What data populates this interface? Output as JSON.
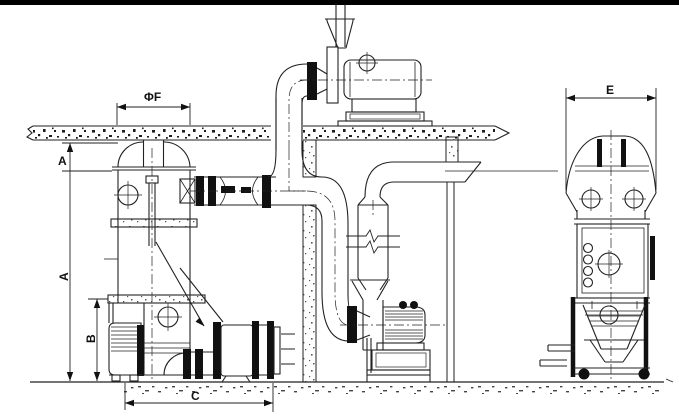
{
  "dimensions": {
    "phi_f": {
      "label": "ΦF"
    },
    "a_top": {
      "label": "A"
    },
    "a": {
      "label": "A"
    },
    "b": {
      "label": "B"
    },
    "c": {
      "label": "C"
    },
    "e": {
      "label": "E"
    }
  },
  "colors": {
    "line": "#222222",
    "background": "#ffffff",
    "top_border": "#000000",
    "flange_fill": "#111111"
  },
  "components": [
    "ceiling-slab",
    "dryer-tower-front-view",
    "butterfly-valve-duct",
    "riser-pipe",
    "roof-exhaust-fan",
    "discharge-stack",
    "wall-column",
    "down-pipe",
    "cyclone-silencer",
    "supply-blower",
    "blower-motor",
    "discharge-drum",
    "support-column",
    "machine-side-view",
    "ground-line"
  ]
}
